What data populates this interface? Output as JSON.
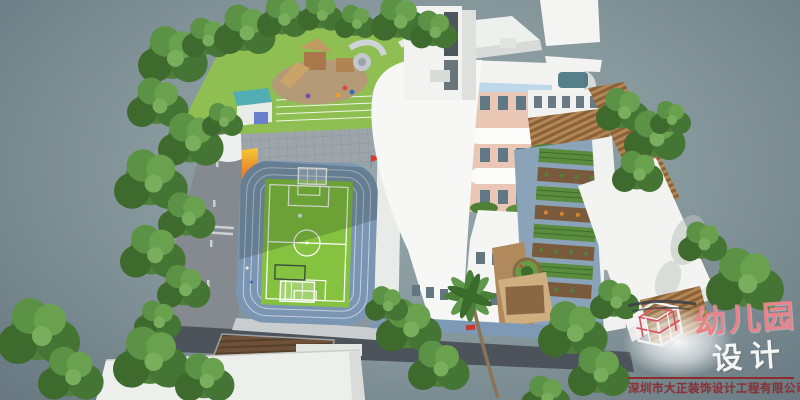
{
  "watermark": {
    "brand_title": "幼儿园",
    "brand_subtitle": "设计",
    "company_name": "深圳市大正装饰设计工程有限公司",
    "logo_icon": "wireframe-cube-logo",
    "colors": {
      "brand": "#e8838b",
      "subtitle": "#f5f5f3",
      "divider": "#8e2c2c",
      "company": "#873338"
    }
  },
  "scene": {
    "elements": [
      "tree-canopy-row",
      "playground-lawn",
      "play-equipment",
      "mini-running-lanes",
      "paved-plaza",
      "football-field",
      "running-track",
      "goal-frames",
      "corner-flag",
      "main-kindergarten-building",
      "colorful-courtyard-facade",
      "striped-tower",
      "timber-pergola",
      "vegetable-garden-beds",
      "round-planter",
      "side-road",
      "service-road",
      "tilled-field",
      "neighbor-rooftops",
      "sand-pit",
      "blue-walkway",
      "wooden-deck",
      "palm-tree",
      "annex-building"
    ],
    "palette": {
      "background_center": "#95a8ab",
      "background_edge": "#465259",
      "field_green": "#84c23f",
      "track_blue": "#7b96b3",
      "lawn_green": "#8fbf52",
      "building_white": "#f6f7f5",
      "tree_green": "#4f7f3a",
      "soil_brown": "#6e5138",
      "garden_path_blue": "#8ba3b8",
      "wood_tan": "#b28755",
      "accent_red": "#d8432f",
      "tower_blue_stripe": "#bcd6ea",
      "tower_tan_stripe": "#c7b49c"
    }
  }
}
